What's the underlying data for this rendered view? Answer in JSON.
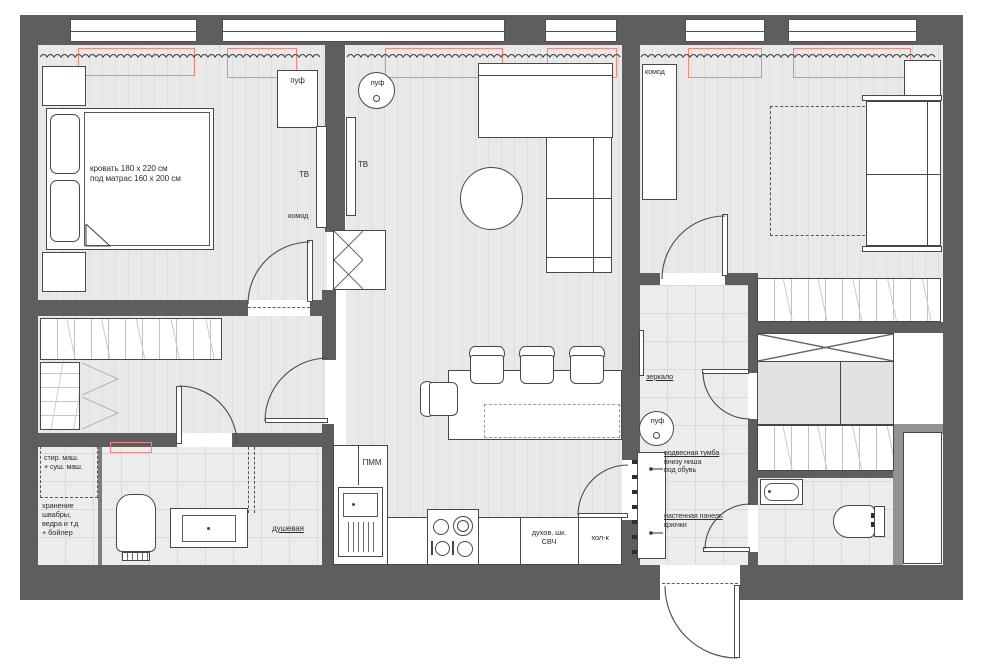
{
  "colors": {
    "wall": "#5e5e5e",
    "wall_secondary": "#929292",
    "radiator_red": "#f0897c",
    "floor": "#e9e9e9",
    "line": "#474747"
  },
  "rooms": {
    "bedroom1": {
      "bed_note": "кровать 180 x 220 см\nпод матрас 160 x 200 см",
      "pouf_label": "пуф",
      "tv_label": "ТВ",
      "dresser_label": "комод"
    },
    "living": {
      "pouf_label": "пуф",
      "tv_label": "ТВ"
    },
    "kitchen": {
      "dishwasher_label": "ПММ",
      "oven_label": "духов. шк.\nСВЧ",
      "fridge_label": "хол-к"
    },
    "bathroom": {
      "washer_label": "стир. маш.\n+ суш. маш.",
      "storage_label": "хранение\nшвабры,\nведра и т.д\n+ бойлер",
      "shower_label": "душевая"
    },
    "hallway": {
      "mirror_label": "зеркало",
      "pouf_label": "пуф",
      "cabinet_title": "подвесная тумба",
      "cabinet_note": "внизу ниша\nпод обувь",
      "panel_title": "настенная панель",
      "panel_note": "крючки"
    },
    "bedroom2": {
      "dresser_label": "комод"
    }
  }
}
